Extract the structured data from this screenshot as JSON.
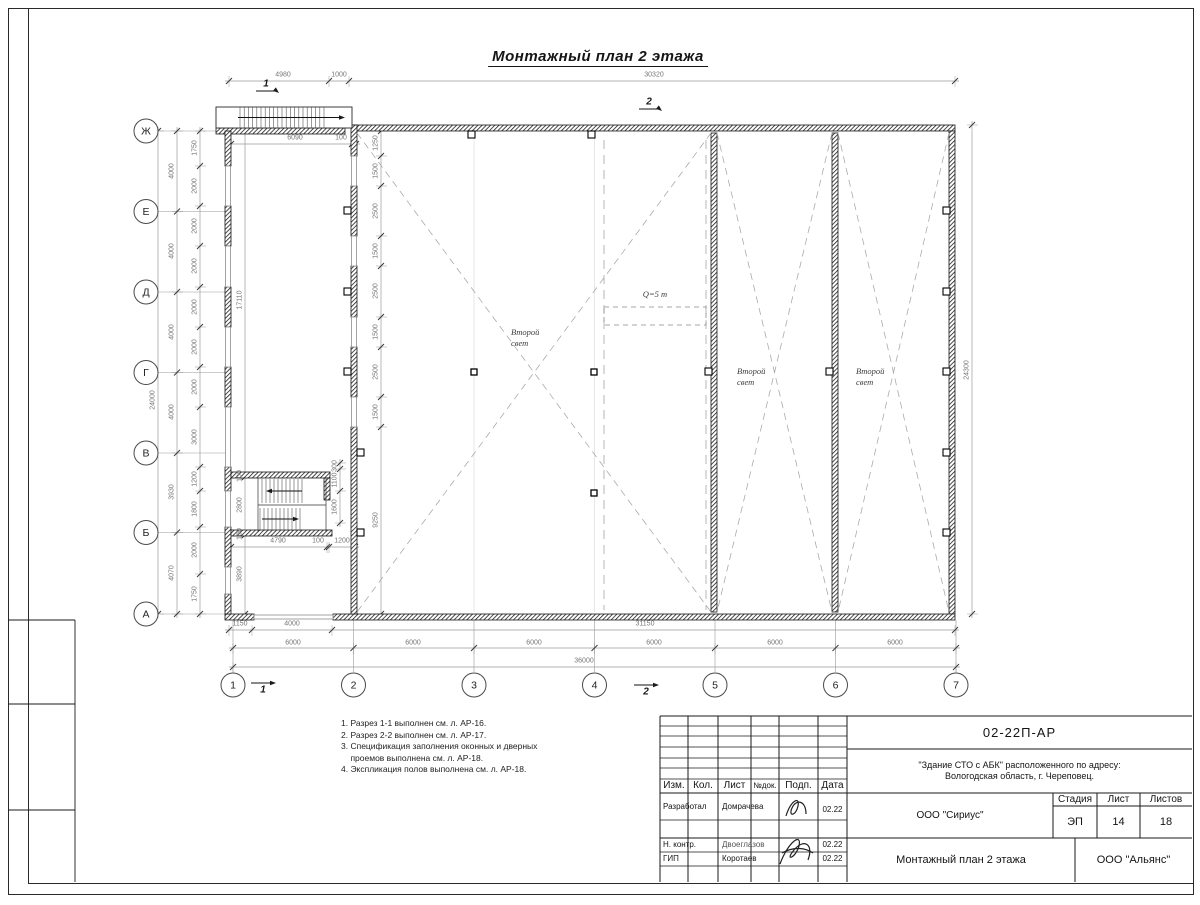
{
  "title": "Монтажный план 2 этажа",
  "labels": {
    "second_light_1": "Второй",
    "second_light_2": "свет",
    "crane": "Q=5 т"
  },
  "axes": {
    "letters": [
      [
        "Ж",
        131
      ],
      [
        "Е",
        211.5
      ],
      [
        "Д",
        292
      ],
      [
        "Г",
        372.5
      ],
      [
        "В",
        453
      ],
      [
        "Б",
        532.5
      ],
      [
        "А",
        614
      ]
    ],
    "numbers": [
      [
        "1",
        233
      ],
      [
        "2",
        353.5
      ],
      [
        "3",
        474
      ],
      [
        "4",
        594.5
      ],
      [
        "5",
        715
      ],
      [
        "6",
        835.5
      ],
      [
        "7",
        956
      ]
    ]
  },
  "section_marks": [
    {
      "label": "1",
      "x": 266,
      "y": 84,
      "dir": "tr"
    },
    {
      "label": "2",
      "x": 649,
      "y": 102,
      "dir": "tr"
    },
    {
      "label": "1",
      "x": 263,
      "y": 690,
      "dir": "br"
    },
    {
      "label": "2",
      "x": 646,
      "y": 692,
      "dir": "br"
    }
  ],
  "dims": [
    [
      "4980",
      283,
      75,
      0
    ],
    [
      "1000",
      339,
      75,
      0
    ],
    [
      "30320",
      654,
      75,
      0
    ],
    [
      "6090",
      295,
      138,
      0
    ],
    [
      "100",
      341,
      138,
      0
    ],
    [
      "4790",
      278,
      541,
      0
    ],
    [
      "100",
      318,
      541,
      0
    ],
    [
      "1200",
      342,
      541,
      0
    ],
    [
      "1150",
      240,
      624,
      0
    ],
    [
      "4000",
      292,
      624,
      0
    ],
    [
      "31150",
      645,
      624,
      0
    ],
    [
      "6000",
      293,
      643,
      0
    ],
    [
      "6000",
      413,
      643,
      0
    ],
    [
      "6000",
      534,
      643,
      0
    ],
    [
      "6000",
      654,
      643,
      0
    ],
    [
      "6000",
      775,
      643,
      0
    ],
    [
      "6000",
      895,
      643,
      0
    ],
    [
      "36000",
      584,
      661,
      0
    ],
    [
      "24000",
      153,
      400,
      1
    ],
    [
      "4000",
      172,
      171,
      1
    ],
    [
      "4000",
      172,
      251,
      1
    ],
    [
      "4000",
      172,
      332,
      1
    ],
    [
      "4000",
      172,
      412,
      1
    ],
    [
      "3930",
      172,
      492,
      1
    ],
    [
      "4070",
      172,
      573,
      1
    ],
    [
      "1750",
      195,
      148,
      1
    ],
    [
      "2000",
      195,
      186,
      1
    ],
    [
      "2000",
      195,
      226,
      1
    ],
    [
      "2000",
      195,
      266,
      1
    ],
    [
      "2000",
      195,
      307,
      1
    ],
    [
      "2000",
      195,
      347,
      1
    ],
    [
      "2000",
      195,
      387,
      1
    ],
    [
      "3000",
      195,
      437,
      1
    ],
    [
      "1200",
      195,
      479,
      1
    ],
    [
      "1800",
      195,
      509,
      1
    ],
    [
      "2000",
      195,
      550,
      1
    ],
    [
      "1750",
      195,
      594,
      1
    ],
    [
      "17110",
      240,
      300,
      1
    ],
    [
      "100",
      240,
      476,
      1
    ],
    [
      "2800",
      240,
      505,
      1
    ],
    [
      "100",
      240,
      534,
      1
    ],
    [
      "3890",
      240,
      574,
      1
    ],
    [
      "1250",
      376,
      143,
      1
    ],
    [
      "1500",
      376,
      171,
      1
    ],
    [
      "2500",
      376,
      211,
      1
    ],
    [
      "1500",
      376,
      251,
      1
    ],
    [
      "2500",
      376,
      291,
      1
    ],
    [
      "1500",
      376,
      332,
      1
    ],
    [
      "2500",
      376,
      372,
      1
    ],
    [
      "1500",
      376,
      412,
      1
    ],
    [
      "9250",
      376,
      520,
      1
    ],
    [
      "300",
      335,
      466,
      1
    ],
    [
      "1100",
      335,
      480,
      1
    ],
    [
      "1600",
      335,
      507,
      1
    ],
    [
      "24300",
      967,
      370,
      1
    ]
  ],
  "second_light_positions": [
    [
      511,
      327
    ],
    [
      737,
      366
    ],
    [
      856,
      366
    ]
  ],
  "crane_pos": [
    655,
    294
  ],
  "notes": [
    "1. Разрез 1-1 выполнен см. л. АР-16.",
    "2. Разрез 2-2 выполнен см. л. АР-17.",
    "3. Спецификация заполнения оконных и дверных",
    "    проемов выполнена см. л. АР-18.",
    "4. Экспликация полов выполнена см. л. АР-18."
  ],
  "titleblock": {
    "doc_code": "02-22П-АР",
    "object_line1": "\"Здание СТО с АБК\" расположенного по адресу:",
    "object_line2": "Вологодская область, г. Череповец.",
    "col_izm": "Изм.",
    "col_kol": "Кол.",
    "col_list": "Лист",
    "col_ndok": "№док.",
    "col_podp": "Подп.",
    "col_data": "Дата",
    "rows": [
      {
        "role": "Разработал",
        "name": "Домрачева",
        "date": "02.22"
      },
      {
        "role": "Н. контр.",
        "name": "Двоеглазов",
        "date": "02.22"
      },
      {
        "role": "ГИП",
        "name": "Коротаев",
        "date": "02.22"
      }
    ],
    "org_design": "ООО \"Сириус\"",
    "stage_h": "Стадия",
    "sheet_h": "Лист",
    "sheets_h": "Листов",
    "stage": "ЭП",
    "sheet": "14",
    "sheets": "18",
    "sheet_title": "Монтажный план 2 этажа",
    "org": "ООО \"Альянс\""
  }
}
